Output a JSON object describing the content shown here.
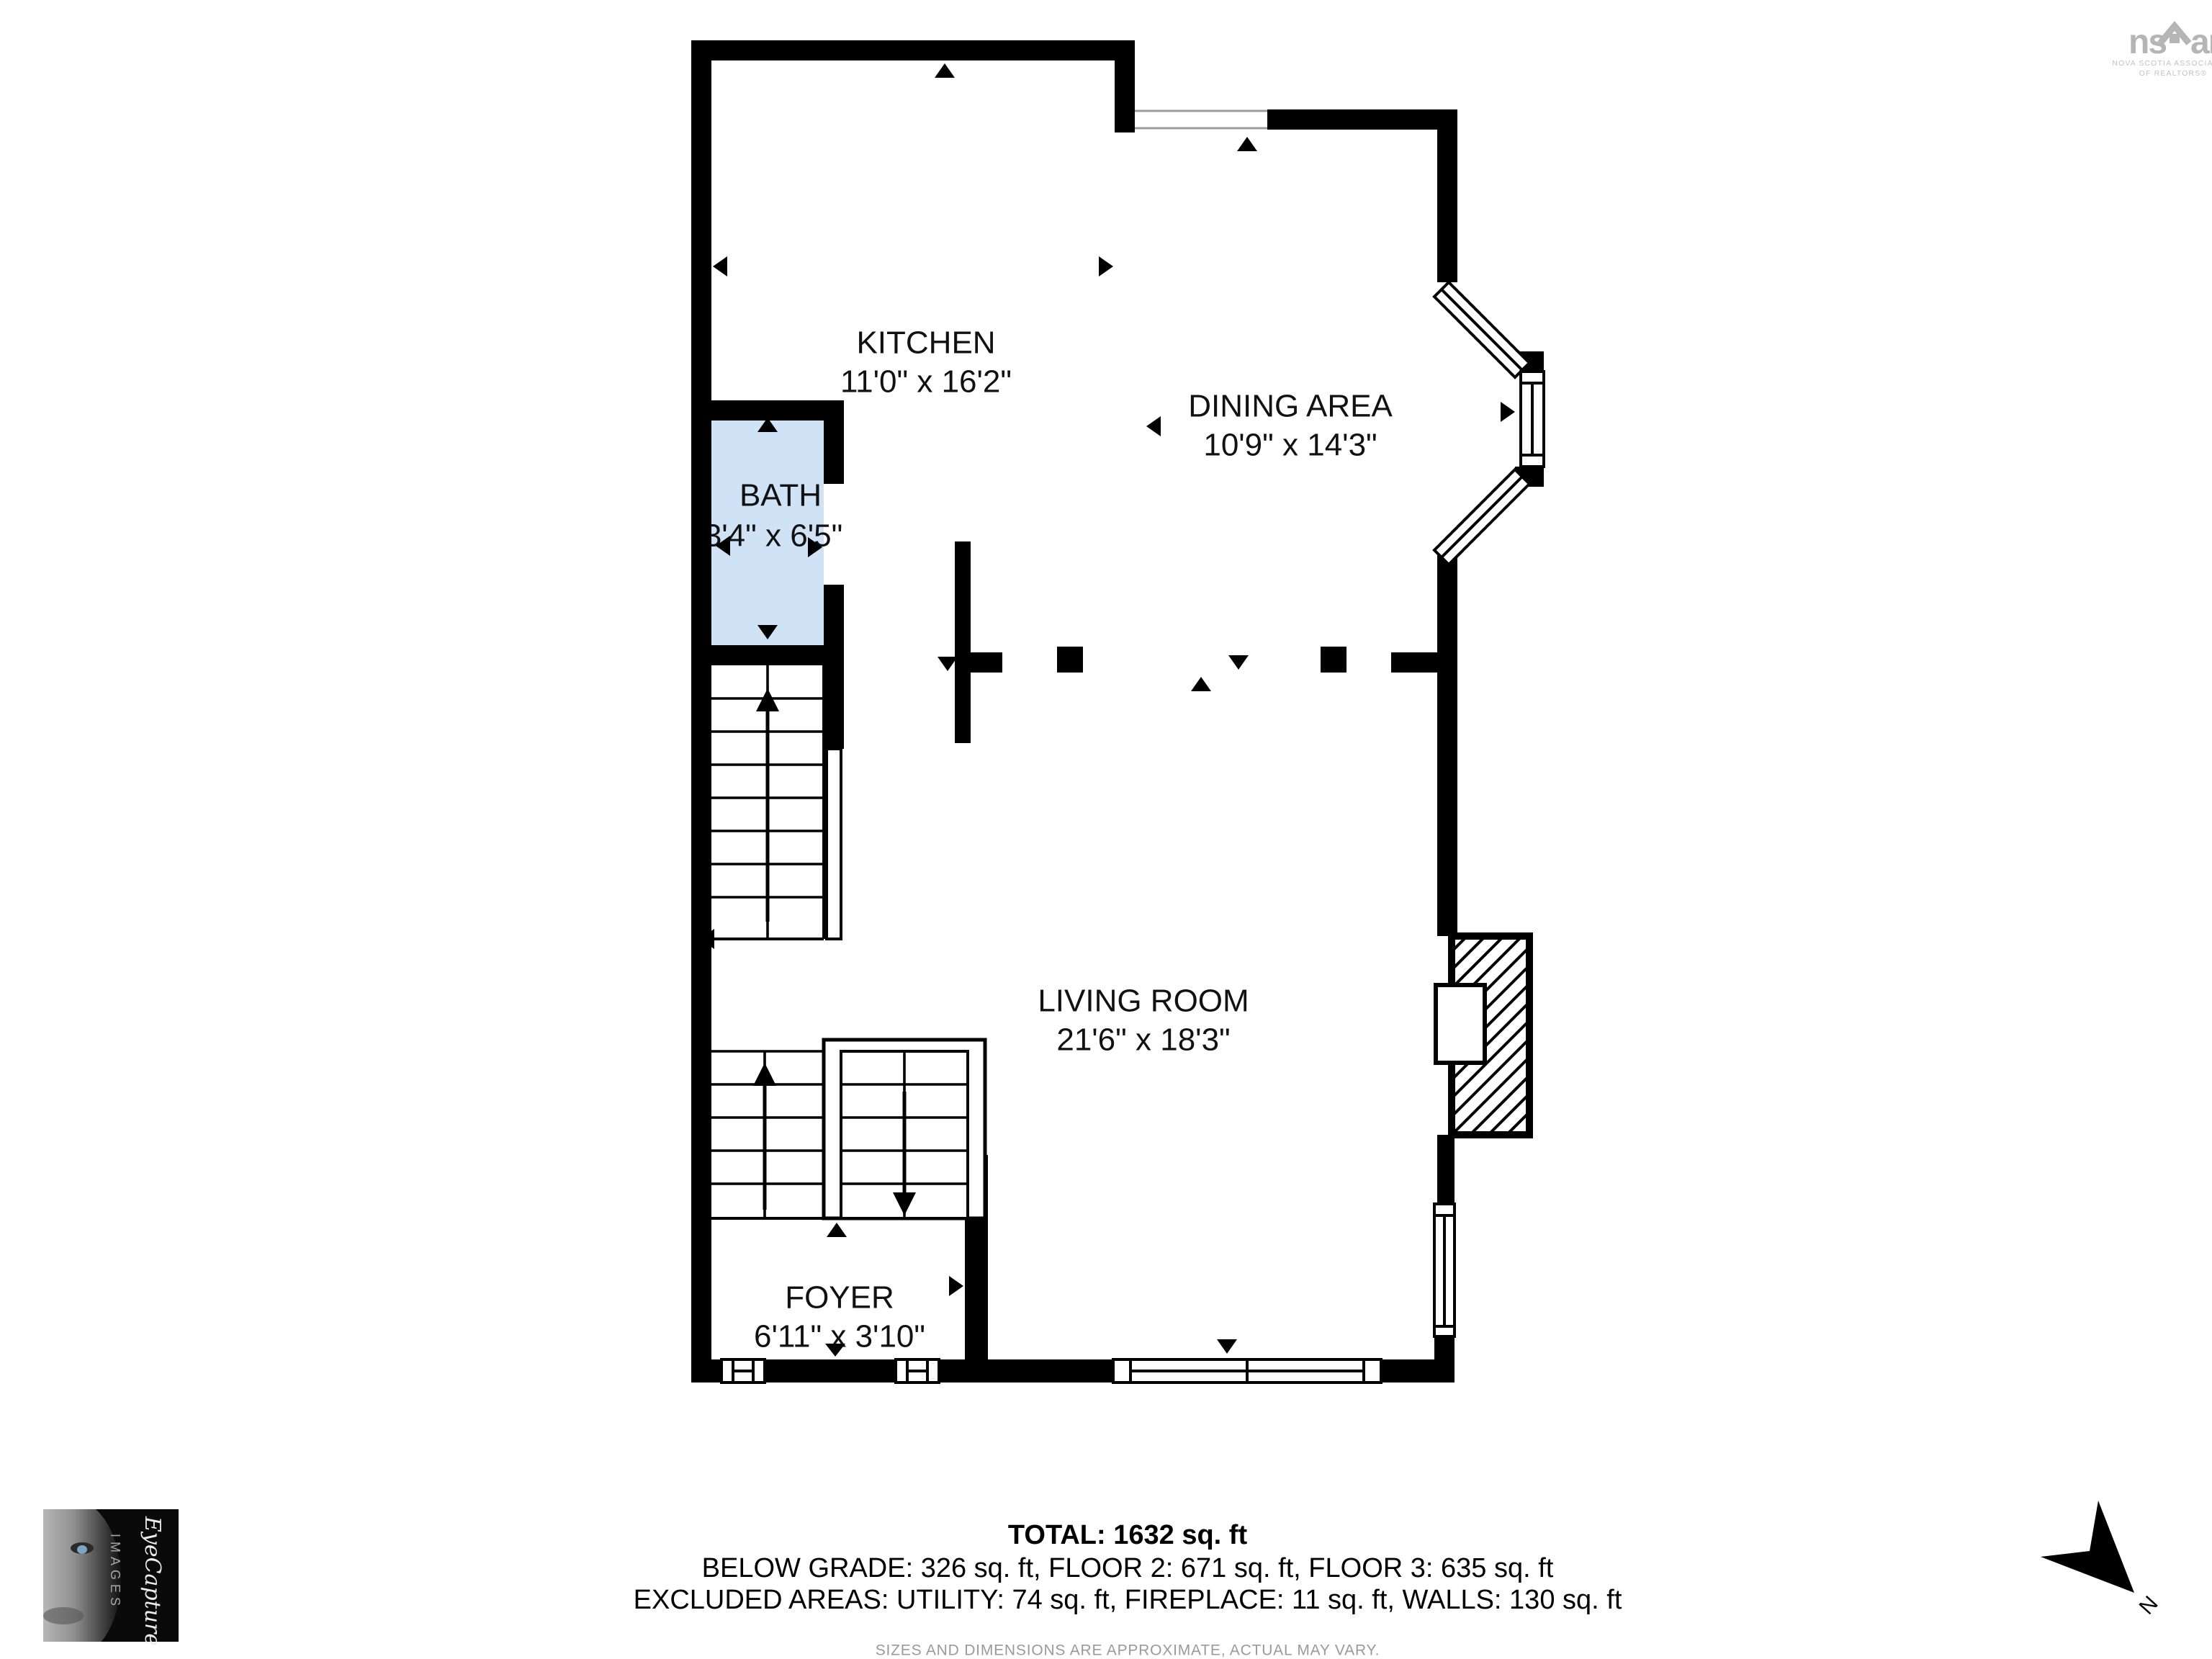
{
  "rooms": {
    "kitchen": {
      "name": "KITCHEN",
      "dims": "11'0\" x 16'2\""
    },
    "dining": {
      "name": "DINING AREA",
      "dims": "10'9\" x 14'3\""
    },
    "bath": {
      "name": "BATH",
      "dims": "3'4\" x 6'5\"",
      "fill": "#cfe2f6"
    },
    "living": {
      "name": "LIVING ROOM",
      "dims": "21'6\" x 18'3\""
    },
    "foyer": {
      "name": "FOYER",
      "dims": "6'11\" x 3'10\""
    }
  },
  "summary": {
    "total": "TOTAL: 1632 sq. ft",
    "floors": "BELOW GRADE: 326 sq. ft, FLOOR 2: 671 sq. ft, FLOOR 3: 635 sq. ft",
    "excluded": "EXCLUDED AREAS: UTILITY: 74 sq. ft, FIREPLACE: 11 sq. ft, WALLS: 130 sq. ft",
    "disclaimer": "SIZES AND DIMENSIONS ARE APPROXIMATE, ACTUAL MAY VARY."
  },
  "branding": {
    "nsar": {
      "left": "ns",
      "right": "ar",
      "caption1": "NOVA SCOTIA ASSOCIATION",
      "caption2": "OF REALTORS®"
    },
    "photographer": {
      "script": "EyeCapture",
      "word": "IMAGES"
    }
  },
  "compass": {
    "label": "N"
  },
  "colors": {
    "wall": "#000000",
    "bath_fill": "#cfe2f6",
    "logo_gray": "#b5b5b5",
    "muted_text": "#9a9a9a"
  }
}
